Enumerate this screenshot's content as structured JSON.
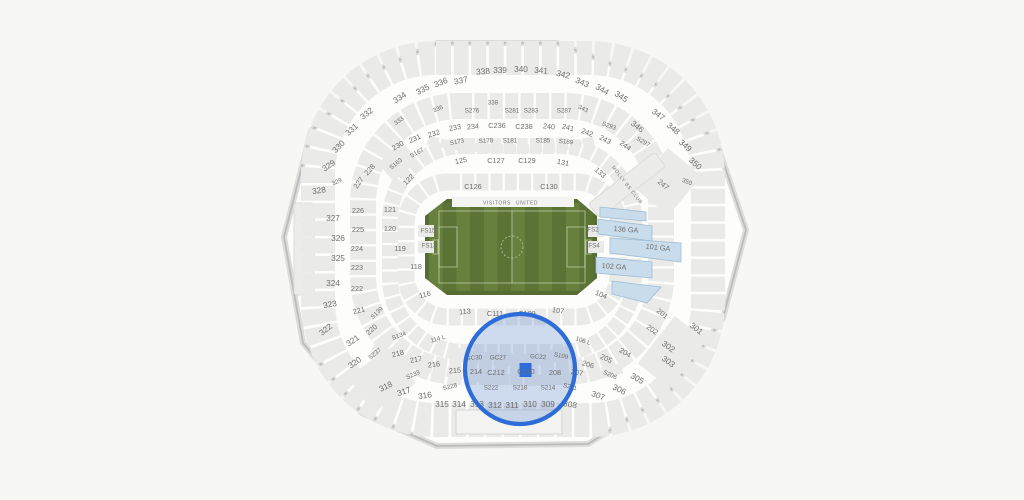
{
  "colors": {
    "background": "#f7f7f4",
    "stadium_fill": "#fdfdfc",
    "stadium_wall": "#bcbcba",
    "section_gray": "#eaeae8",
    "label_gray": "#6e6e6c",
    "field_green_dark": "#566c32",
    "field_stripe_a": "#67803e",
    "field_stripe_b": "#5c7336",
    "ga_blue_fill": "#c9dcec",
    "ga_blue_stroke": "#9dbdd6",
    "selection_blue": "#2e6cd8"
  },
  "field": {
    "visitors_label": "VISITORS",
    "home_label": "UNITED"
  },
  "club": {
    "label": "MOLLY BS CLUB"
  },
  "selection": {
    "section": "C210"
  },
  "labels": [
    {
      "t": "330",
      "x": 339,
      "y": 147,
      "s": "lg",
      "r": -45
    },
    {
      "t": "331",
      "x": 352,
      "y": 130,
      "s": "lg",
      "r": -42
    },
    {
      "t": "332",
      "x": 367,
      "y": 114,
      "s": "lg",
      "r": -38
    },
    {
      "t": "333",
      "x": 399,
      "y": 121,
      "s": "sm",
      "r": -36
    },
    {
      "t": "334",
      "x": 400,
      "y": 98,
      "s": "lg",
      "r": -33
    },
    {
      "t": "335",
      "x": 423,
      "y": 90,
      "s": "lg",
      "r": -28
    },
    {
      "t": "336",
      "x": 441,
      "y": 83,
      "s": "lg",
      "r": -22
    },
    {
      "t": "336",
      "x": 438,
      "y": 109,
      "s": "sm",
      "r": -22
    },
    {
      "t": "337",
      "x": 461,
      "y": 81,
      "s": "lg",
      "r": -12
    },
    {
      "t": "338",
      "x": 483,
      "y": 72,
      "s": "lg",
      "r": -4
    },
    {
      "t": "338",
      "x": 493,
      "y": 103,
      "s": "sm",
      "r": 0
    },
    {
      "t": "339",
      "x": 500,
      "y": 71,
      "s": "lg",
      "r": 0
    },
    {
      "t": "340",
      "x": 521,
      "y": 70,
      "s": "lg",
      "r": 0
    },
    {
      "t": "341",
      "x": 541,
      "y": 71,
      "s": "lg",
      "r": 4
    },
    {
      "t": "342",
      "x": 563,
      "y": 75,
      "s": "lg",
      "r": 14
    },
    {
      "t": "343",
      "x": 582,
      "y": 83,
      "s": "lg",
      "r": 24
    },
    {
      "t": "343",
      "x": 583,
      "y": 109,
      "s": "sm",
      "r": 25
    },
    {
      "t": "344",
      "x": 602,
      "y": 90,
      "s": "lg",
      "r": 30
    },
    {
      "t": "345",
      "x": 621,
      "y": 97,
      "s": "lg",
      "r": 33
    },
    {
      "t": "346",
      "x": 637,
      "y": 127,
      "s": "lg",
      "r": 38
    },
    {
      "t": "347",
      "x": 658,
      "y": 115,
      "s": "lg",
      "r": 38
    },
    {
      "t": "348",
      "x": 673,
      "y": 129,
      "s": "lg",
      "r": 40
    },
    {
      "t": "349",
      "x": 685,
      "y": 146,
      "s": "lg",
      "r": 42
    },
    {
      "t": "350",
      "x": 695,
      "y": 164,
      "s": "lg",
      "r": 42
    },
    {
      "t": "350",
      "x": 687,
      "y": 182,
      "s": "sm",
      "r": 22
    },
    {
      "t": "247",
      "x": 663,
      "y": 185,
      "s": "md",
      "r": 40
    },
    {
      "t": "133",
      "x": 600,
      "y": 173,
      "s": "md",
      "r": 42
    },
    {
      "t": "131",
      "x": 563,
      "y": 163,
      "s": "md",
      "r": 12
    },
    {
      "t": "125",
      "x": 461,
      "y": 161,
      "s": "md",
      "r": -10
    },
    {
      "t": "122",
      "x": 409,
      "y": 180,
      "s": "md",
      "r": -45
    },
    {
      "t": "329",
      "x": 329,
      "y": 166,
      "s": "lg",
      "r": -35
    },
    {
      "t": "329",
      "x": 337,
      "y": 182,
      "s": "sm",
      "r": -25
    },
    {
      "t": "328",
      "x": 319,
      "y": 191,
      "s": "lg",
      "r": -8
    },
    {
      "t": "327",
      "x": 333,
      "y": 219,
      "s": "lg",
      "r": 0
    },
    {
      "t": "326",
      "x": 338,
      "y": 239,
      "s": "lg",
      "r": 0
    },
    {
      "t": "325",
      "x": 338,
      "y": 259,
      "s": "lg",
      "r": 0
    },
    {
      "t": "324",
      "x": 333,
      "y": 284,
      "s": "lg",
      "r": 0
    },
    {
      "t": "323",
      "x": 330,
      "y": 305,
      "s": "lg",
      "r": -10
    },
    {
      "t": "322",
      "x": 326,
      "y": 330,
      "s": "lg",
      "r": -38
    },
    {
      "t": "321",
      "x": 353,
      "y": 341,
      "s": "lg",
      "r": -35
    },
    {
      "t": "320",
      "x": 355,
      "y": 363,
      "s": "lg",
      "r": -35
    },
    {
      "t": "318",
      "x": 386,
      "y": 387,
      "s": "lg",
      "r": -26
    },
    {
      "t": "317",
      "x": 404,
      "y": 392,
      "s": "lg",
      "r": -18
    },
    {
      "t": "316",
      "x": 425,
      "y": 396,
      "s": "lg",
      "r": -8
    },
    {
      "t": "315",
      "x": 442,
      "y": 405,
      "s": "lg",
      "r": 0
    },
    {
      "t": "314",
      "x": 459,
      "y": 405,
      "s": "lg",
      "r": 0
    },
    {
      "t": "313",
      "x": 477,
      "y": 405,
      "s": "lg",
      "r": 0
    },
    {
      "t": "312",
      "x": 495,
      "y": 406,
      "s": "lg",
      "r": 0
    },
    {
      "t": "311",
      "x": 512,
      "y": 406,
      "s": "lg",
      "r": 0
    },
    {
      "t": "310",
      "x": 530,
      "y": 405,
      "s": "lg",
      "r": 0
    },
    {
      "t": "309",
      "x": 548,
      "y": 405,
      "s": "lg",
      "r": 0
    },
    {
      "t": "308",
      "x": 570,
      "y": 405,
      "s": "lg",
      "r": 10
    },
    {
      "t": "307",
      "x": 598,
      "y": 396,
      "s": "lg",
      "r": 20
    },
    {
      "t": "306",
      "x": 619,
      "y": 390,
      "s": "lg",
      "r": 26
    },
    {
      "t": "305",
      "x": 637,
      "y": 379,
      "s": "lg",
      "r": 30
    },
    {
      "t": "303",
      "x": 668,
      "y": 362,
      "s": "lg",
      "r": 36
    },
    {
      "t": "302",
      "x": 668,
      "y": 347,
      "s": "lg",
      "r": 36
    },
    {
      "t": "301",
      "x": 696,
      "y": 329,
      "s": "lg",
      "r": 38
    },
    {
      "t": "230",
      "x": 398,
      "y": 146,
      "s": "md",
      "r": -30
    },
    {
      "t": "231",
      "x": 415,
      "y": 139,
      "s": "md",
      "r": -24
    },
    {
      "t": "232",
      "x": 434,
      "y": 134,
      "s": "md",
      "r": -18
    },
    {
      "t": "233",
      "x": 455,
      "y": 128,
      "s": "md",
      "r": -10
    },
    {
      "t": "234",
      "x": 473,
      "y": 127,
      "s": "md",
      "r": -5
    },
    {
      "t": "C236",
      "x": 497,
      "y": 126,
      "s": "md",
      "r": 0
    },
    {
      "t": "C238",
      "x": 524,
      "y": 127,
      "s": "md",
      "r": 0
    },
    {
      "t": "240",
      "x": 549,
      "y": 127,
      "s": "md",
      "r": 6
    },
    {
      "t": "241",
      "x": 568,
      "y": 128,
      "s": "md",
      "r": 14
    },
    {
      "t": "242",
      "x": 587,
      "y": 133,
      "s": "md",
      "r": 22
    },
    {
      "t": "243",
      "x": 605,
      "y": 140,
      "s": "md",
      "r": 28
    },
    {
      "t": "244",
      "x": 625,
      "y": 146,
      "s": "md",
      "r": 36
    },
    {
      "t": "228",
      "x": 370,
      "y": 170,
      "s": "md",
      "r": -48
    },
    {
      "t": "227",
      "x": 359,
      "y": 183,
      "s": "md",
      "r": -55
    },
    {
      "t": "226",
      "x": 358,
      "y": 211,
      "s": "md",
      "r": 0
    },
    {
      "t": "225",
      "x": 358,
      "y": 230,
      "s": "md",
      "r": 0
    },
    {
      "t": "224",
      "x": 357,
      "y": 249,
      "s": "md",
      "r": 0
    },
    {
      "t": "223",
      "x": 357,
      "y": 268,
      "s": "md",
      "r": 0
    },
    {
      "t": "222",
      "x": 357,
      "y": 289,
      "s": "md",
      "r": 0
    },
    {
      "t": "221",
      "x": 359,
      "y": 311,
      "s": "md",
      "r": -15
    },
    {
      "t": "220",
      "x": 372,
      "y": 330,
      "s": "md",
      "r": -42
    },
    {
      "t": "218",
      "x": 398,
      "y": 354,
      "s": "md",
      "r": -14
    },
    {
      "t": "217",
      "x": 416,
      "y": 360,
      "s": "md",
      "r": -10
    },
    {
      "t": "216",
      "x": 434,
      "y": 365,
      "s": "md",
      "r": -7
    },
    {
      "t": "215",
      "x": 455,
      "y": 371,
      "s": "md",
      "r": -4
    },
    {
      "t": "214",
      "x": 476,
      "y": 372,
      "s": "md",
      "r": 0
    },
    {
      "t": "C212",
      "x": 496,
      "y": 373,
      "s": "md",
      "r": 0
    },
    {
      "t": "C210",
      "x": 526,
      "y": 372,
      "s": "md",
      "r": 0
    },
    {
      "t": "208",
      "x": 555,
      "y": 373,
      "s": "md",
      "r": 0
    },
    {
      "t": "207",
      "x": 577,
      "y": 373,
      "s": "md",
      "r": 10
    },
    {
      "t": "206",
      "x": 588,
      "y": 365,
      "s": "md",
      "r": 16
    },
    {
      "t": "205",
      "x": 606,
      "y": 359,
      "s": "md",
      "r": 24
    },
    {
      "t": "204",
      "x": 625,
      "y": 353,
      "s": "md",
      "r": 30
    },
    {
      "t": "202",
      "x": 652,
      "y": 330,
      "s": "md",
      "r": 36
    },
    {
      "t": "201",
      "x": 662,
      "y": 314,
      "s": "md",
      "r": 38
    },
    {
      "t": "S211",
      "x": 570,
      "y": 387,
      "s": "sm",
      "r": 14
    },
    {
      "t": "GC30",
      "x": 474,
      "y": 358,
      "s": "sm",
      "r": -4
    },
    {
      "t": "GC27",
      "x": 498,
      "y": 358,
      "s": "sm",
      "r": 0
    },
    {
      "t": "GC22",
      "x": 538,
      "y": 357,
      "s": "sm",
      "r": 4
    },
    {
      "t": "S276",
      "x": 472,
      "y": 111,
      "s": "sm",
      "r": 0
    },
    {
      "t": "S281",
      "x": 512,
      "y": 111,
      "s": "sm",
      "r": 0
    },
    {
      "t": "S283",
      "x": 531,
      "y": 111,
      "s": "sm",
      "r": 0
    },
    {
      "t": "S287",
      "x": 564,
      "y": 111,
      "s": "sm",
      "r": 0
    },
    {
      "t": "S293",
      "x": 609,
      "y": 126,
      "s": "sm",
      "r": 20
    },
    {
      "t": "S297",
      "x": 643,
      "y": 142,
      "s": "sm",
      "r": 30
    },
    {
      "t": "S167",
      "x": 417,
      "y": 153,
      "s": "sm",
      "r": -28
    },
    {
      "t": "S163",
      "x": 396,
      "y": 164,
      "s": "sm",
      "r": -40
    },
    {
      "t": "S173",
      "x": 457,
      "y": 142,
      "s": "sm",
      "r": -12
    },
    {
      "t": "S178",
      "x": 486,
      "y": 141,
      "s": "sm",
      "r": -4
    },
    {
      "t": "S181",
      "x": 510,
      "y": 141,
      "s": "sm",
      "r": 0
    },
    {
      "t": "S185",
      "x": 543,
      "y": 141,
      "s": "sm",
      "r": 0
    },
    {
      "t": "S189",
      "x": 566,
      "y": 142,
      "s": "sm",
      "r": 6
    },
    {
      "t": "S139",
      "x": 377,
      "y": 313,
      "s": "sm",
      "r": -45
    },
    {
      "t": "S134",
      "x": 399,
      "y": 336,
      "s": "sm",
      "r": -20
    },
    {
      "t": "S237",
      "x": 375,
      "y": 354,
      "s": "sm",
      "r": -40
    },
    {
      "t": "S233",
      "x": 413,
      "y": 375,
      "s": "sm",
      "r": -24
    },
    {
      "t": "S228",
      "x": 450,
      "y": 387,
      "s": "sm",
      "r": -14
    },
    {
      "t": "S222",
      "x": 491,
      "y": 388,
      "s": "sm",
      "r": 0
    },
    {
      "t": "S218",
      "x": 520,
      "y": 388,
      "s": "sm",
      "r": 0
    },
    {
      "t": "S214",
      "x": 548,
      "y": 388,
      "s": "sm",
      "r": 0
    },
    {
      "t": "S206",
      "x": 610,
      "y": 375,
      "s": "sm",
      "r": 24
    },
    {
      "t": "S109",
      "x": 561,
      "y": 356,
      "s": "sm",
      "r": 12
    },
    {
      "t": "C126",
      "x": 473,
      "y": 187,
      "s": "md",
      "r": 0
    },
    {
      "t": "C130",
      "x": 549,
      "y": 187,
      "s": "md",
      "r": 0
    },
    {
      "t": "C127",
      "x": 496,
      "y": 161,
      "s": "md",
      "r": 0
    },
    {
      "t": "C129",
      "x": 527,
      "y": 161,
      "s": "md",
      "r": 0
    },
    {
      "t": "121",
      "x": 390,
      "y": 210,
      "s": "md",
      "r": 0
    },
    {
      "t": "120",
      "x": 390,
      "y": 229,
      "s": "md",
      "r": 0
    },
    {
      "t": "119",
      "x": 400,
      "y": 249,
      "s": "md",
      "r": 0
    },
    {
      "t": "118",
      "x": 416,
      "y": 267,
      "s": "md",
      "r": 0
    },
    {
      "t": "116",
      "x": 425,
      "y": 295,
      "s": "md",
      "r": -15
    },
    {
      "t": "113",
      "x": 465,
      "y": 312,
      "s": "md",
      "r": -6
    },
    {
      "t": "C111",
      "x": 495,
      "y": 314,
      "s": "md",
      "r": 0
    },
    {
      "t": "C109",
      "x": 527,
      "y": 314,
      "s": "md",
      "r": 0
    },
    {
      "t": "107",
      "x": 558,
      "y": 311,
      "s": "md",
      "r": 8
    },
    {
      "t": "104",
      "x": 601,
      "y": 295,
      "s": "md",
      "r": 22
    },
    {
      "t": "106 L",
      "x": 583,
      "y": 341,
      "s": "sm",
      "r": 18
    },
    {
      "t": "114 L",
      "x": 438,
      "y": 339,
      "s": "sm",
      "r": -16
    },
    {
      "t": "FS15",
      "x": 428,
      "y": 231,
      "s": "sm",
      "r": 0
    },
    {
      "t": "FS13",
      "x": 429,
      "y": 246,
      "s": "sm",
      "r": 0
    },
    {
      "t": "FS2",
      "x": 593,
      "y": 230,
      "s": "sm",
      "r": 0
    },
    {
      "t": "FS4",
      "x": 594,
      "y": 246,
      "s": "sm",
      "r": 0
    },
    {
      "t": "136 GA",
      "x": 626,
      "y": 230,
      "s": "md",
      "r": 4
    },
    {
      "t": "101 GA",
      "x": 658,
      "y": 248,
      "s": "md",
      "r": 6
    },
    {
      "t": "102 GA",
      "x": 614,
      "y": 267,
      "s": "md",
      "r": 4
    }
  ]
}
